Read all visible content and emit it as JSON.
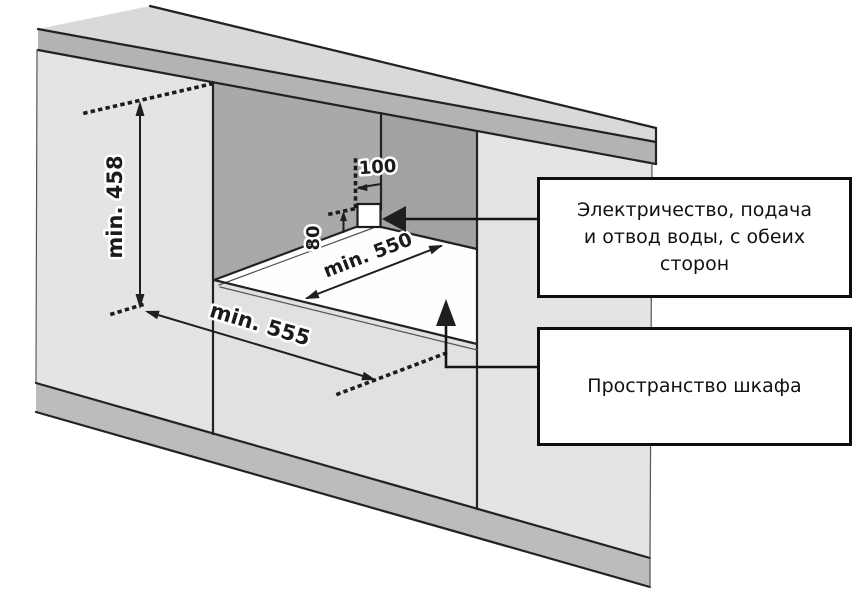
{
  "diagram": {
    "title": "built-in-appliance-cabinet-niche-installation",
    "dimensions": {
      "niche_height": "min. 458",
      "niche_depth": "min. 555",
      "niche_width": "min. 550",
      "service_offset": "100",
      "service_height": "80"
    },
    "callout_utilities": {
      "lines": [
        "Электричество, подача",
        "и отвод воды, с обеих",
        "сторон"
      ]
    },
    "callout_cabinet": {
      "text": "Пространство шкафа"
    },
    "palette": {
      "countertop_top": "#d9d9d9",
      "countertop_edge": "#b3b3b3",
      "panel": "#e4e4e4",
      "front_base": "#e1e1e1",
      "niche_back_wall": "#a9a9a9",
      "niche_side_wall": "#a2a2a2",
      "plinth": "#bcbcbc",
      "floor": "#fefefe",
      "line": "#1f1f1f",
      "text": "#111111"
    }
  }
}
